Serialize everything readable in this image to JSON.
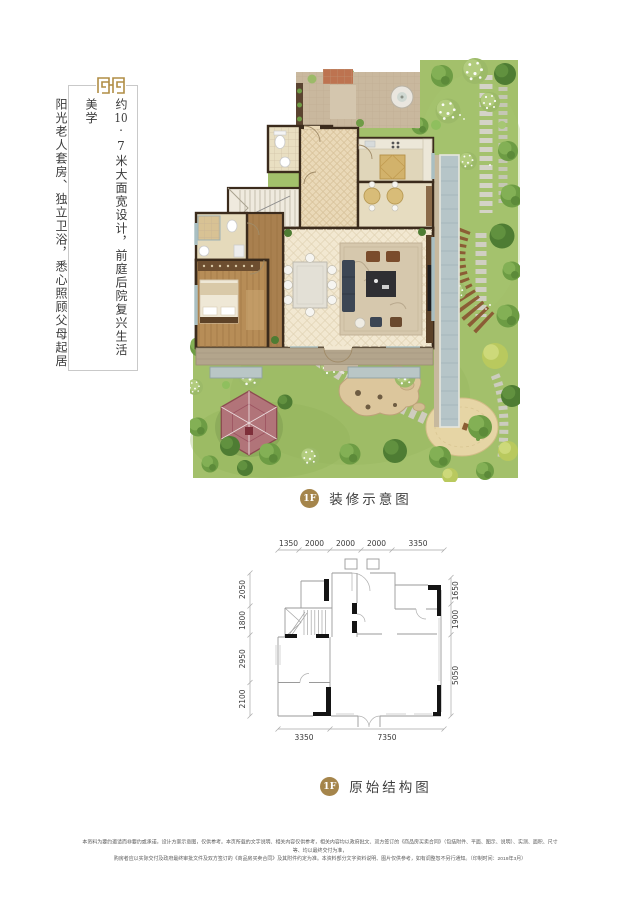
{
  "left_panel": {
    "slogan1_prefix": "约",
    "slogan1_number": "10",
    "slogan1_rest": "·7米大面宽设计，前庭后院复兴生活美学",
    "slogan2": "阳光老人套房、独立卫浴，悉心照顾父母起居"
  },
  "captions": {
    "decorated": {
      "badge": "1F",
      "label": "装修示意图"
    },
    "structure": {
      "badge": "1F",
      "label": "原始结构图"
    }
  },
  "structure_plan": {
    "dims_top": [
      "1350",
      "2000",
      "2000",
      "2000",
      "3350"
    ],
    "dims_left": [
      "2050",
      "1800",
      "2950",
      "2100"
    ],
    "dims_right": [
      "1650",
      "1900",
      "5050"
    ],
    "dims_bottom": [
      "3350",
      "7350"
    ]
  },
  "colors": {
    "gold": "#a5854b",
    "ornament_gold": "#b08d45",
    "lawn_green": "#a3c06b",
    "wall_brown": "#3b2b1c"
  },
  "footer": {
    "line1": "本资料为要约邀请而非要约或承诺，设计方案示意图，仅供参考。本页所载的文字说明、相关内容仅供参考，相关内容均以政府批文、双方签订的《商品房买卖合同》（包括附件、平面、图示、说明）、实测、面积、尺寸等、均以最终交付为准，",
    "line2": "购房者应以实际交付及政府最终审批文件及双方签订的《商品房买卖合同》及其附件约定为准。本资料部分文字资料说明、图片仅供参考，如有调整恕不另行通知。（印制时间：2019年3月）"
  }
}
